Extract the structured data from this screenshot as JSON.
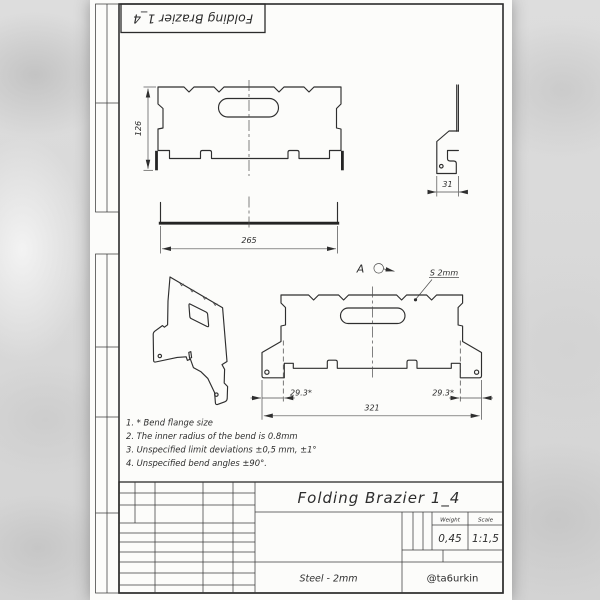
{
  "colors": {
    "ink": "#2e2e2e",
    "paper": "#fcfcfa"
  },
  "top_stamp": {
    "label": "Folding Brazier 1_4"
  },
  "views": {
    "front": {
      "height_dim": "126",
      "bottom_width_dim": "265"
    },
    "side": {
      "flange_dim": "31"
    },
    "flat": {
      "view_label": "A",
      "thickness_label": "S 2mm",
      "bend_dim_left": "29.3*",
      "bend_dim_right": "29.3*",
      "overall_dim": "321"
    }
  },
  "notes": {
    "line1": "1.  * Bend flange size",
    "line2": "2.  The inner radius of the bend is 0.8mm",
    "line3": "3.  Unspecified limit deviations ±0,5 mm, ±1°",
    "line4": "4.  Unspecified bend angles ±90°."
  },
  "title_block": {
    "title": "Folding Brazier 1_4",
    "weight_label": "Weight",
    "scale_label": "Scale",
    "weight_value": "0,45",
    "scale_value": "1:1,5",
    "material": "Steel - 2mm",
    "author": "@ta6urkin"
  }
}
